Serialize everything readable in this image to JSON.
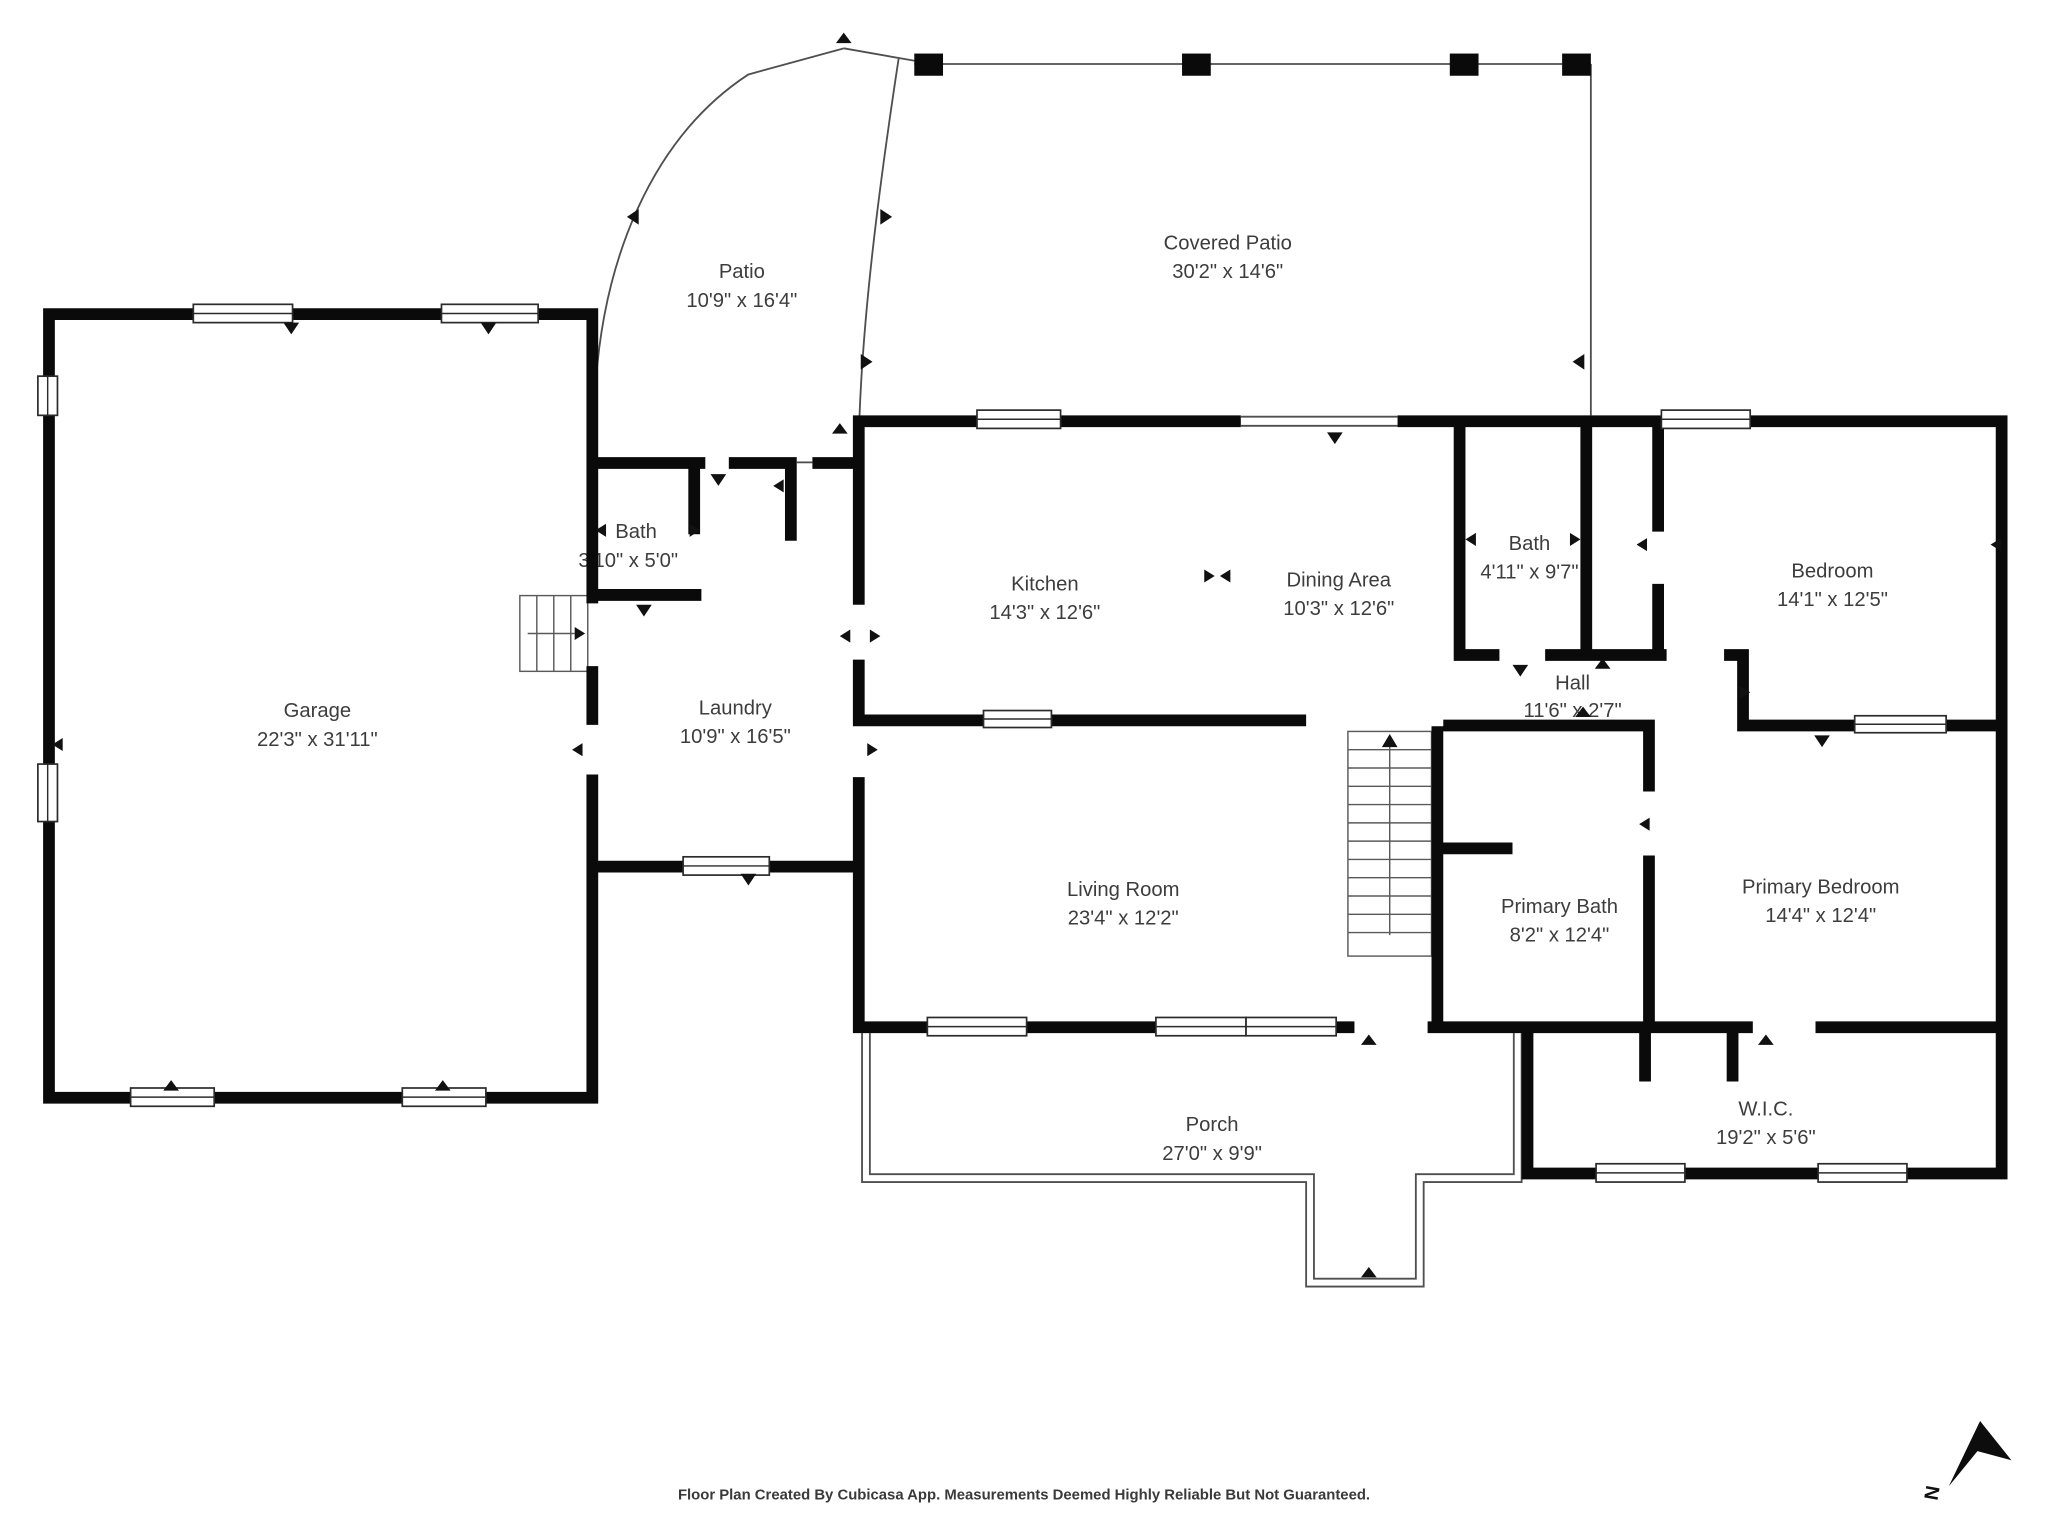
{
  "rooms": {
    "patio": {
      "name": "Patio",
      "dims": "10'9\" x 16'4\""
    },
    "covered_patio": {
      "name": "Covered Patio",
      "dims": "30'2\" x 14'6\""
    },
    "garage": {
      "name": "Garage",
      "dims": "22'3\" x 31'11\""
    },
    "bath_small": {
      "name": "Bath",
      "dims": "3'10\" x 5'0\""
    },
    "laundry": {
      "name": "Laundry",
      "dims": "10'9\" x 16'5\""
    },
    "kitchen": {
      "name": "Kitchen",
      "dims": "14'3\" x 12'6\""
    },
    "dining": {
      "name": "Dining Area",
      "dims": "10'3\" x 12'6\""
    },
    "bath": {
      "name": "Bath",
      "dims": "4'11\" x 9'7\""
    },
    "bedroom": {
      "name": "Bedroom",
      "dims": "14'1\" x 12'5\""
    },
    "hall": {
      "name": "Hall",
      "dims": "11'6\" x 2'7\""
    },
    "living_room": {
      "name": "Living Room",
      "dims": "23'4\" x 12'2\""
    },
    "primary_bath": {
      "name": "Primary Bath",
      "dims": "8'2\" x 12'4\""
    },
    "primary_bedroom": {
      "name": "Primary Bedroom",
      "dims": "14'4\" x 12'4\""
    },
    "porch": {
      "name": "Porch",
      "dims": "27'0\" x 9'9\""
    },
    "wic": {
      "name": "W.I.C.",
      "dims": "19'2\" x 5'6\""
    }
  },
  "footer": {
    "text": "Floor Plan Created By Cubicasa App. Measurements Deemed Highly Reliable But Not Guaranteed."
  },
  "compass": {
    "label": "N"
  },
  "colors": {
    "wall": "#0a0a0a",
    "thin_outline": "#4f4f4f",
    "label": "#3d3d3d",
    "background": "#ffffff"
  }
}
